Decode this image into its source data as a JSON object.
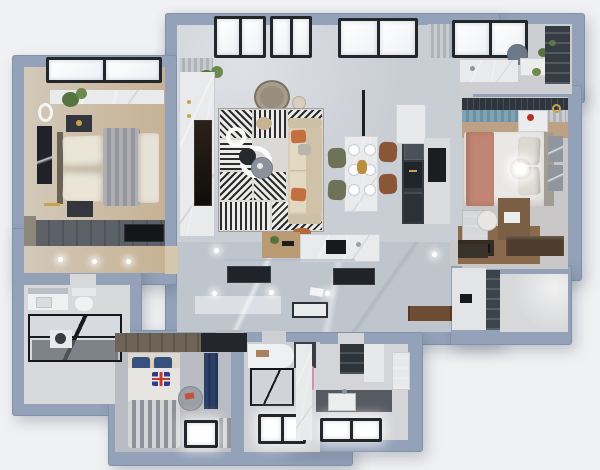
{
  "scene": {
    "type": "3d-floor-plan-top-view",
    "description": "Photorealistic top-down 3D render of a furnished apartment floor plan with blue-gray walls on a light background",
    "background_color": "#f0f1f3",
    "wall_color": "#93a2b9"
  },
  "palette": {
    "bg": "#f0f1f3",
    "wall": "#93a2b9",
    "wall-edge": "#8191aa",
    "glass-frame": "#23262b",
    "window-glass": "#fafbfd",
    "marble-floor": "#c9cdd4",
    "marble-dark": "#bfc5cd",
    "marble-white": "#e9eaec",
    "wood": "#c7b193",
    "wood-light": "#d6c6ab",
    "wood-dark": "#7a5f45",
    "dark-cabinet": "#343a42",
    "charcoal": "#202329",
    "white-soft": "#eceded",
    "sofa-beige": "#d9cdb6",
    "accent-orange": "#c4703e",
    "accent-salmon": "#c08573",
    "accent-navy": "#2c4066",
    "accent-teal": "#7fa3b5",
    "accent-pink": "#d98fa6",
    "accent-green": "#55743f",
    "chair-olive": "#6e7257",
    "chair-brown": "#8a5638",
    "accent-gold": "#c9a34a",
    "duvet-gray": "#9fa1a5",
    "floor-gray": "#b9bcc2",
    "bath-floor": "#d8d9db",
    "rug-base": "#dad9d5"
  },
  "rooms": [
    {
      "id": "living-room",
      "label": "Living Room",
      "furniture": [
        "interior-curtain",
        "potted-plant",
        "papasan-chair",
        "arc-floor-lamp",
        "marble-tv-wall",
        "wall-tv",
        "geometric-patch-rug",
        "nesting-ring-coffee-tables",
        "black-side-stool",
        "serving-tray",
        "round-cushion",
        "three-seat-sofa",
        "orange-accent-pillows",
        "orange-ottoman",
        "skylight-windows",
        "sheer-curtain",
        "wood-bar-counter",
        "island-counter-with-cooktop",
        "glass-screen"
      ]
    },
    {
      "id": "dining-area",
      "label": "Dining Area",
      "furniture": [
        "marble-dining-table",
        "six-place-settings",
        "gold-centerpiece",
        "linear-pendant-lamp",
        "olive-green-chairs",
        "terracotta-leather-chairs"
      ]
    },
    {
      "id": "kitchen",
      "label": "Kitchen",
      "furniture": [
        "tall-appliance-column",
        "built-in-ovens",
        "coffee-machine-niche",
        "white-wall-cabinet",
        "stone-counter",
        "black-appliance-deck"
      ]
    },
    {
      "id": "kitchen-balcony",
      "label": "Kitchen Balcony",
      "furniture": [
        "round-water-heater",
        "marble-counter",
        "sink-faucet",
        "white-appliance-box",
        "potted-plants",
        "tall-shelf-cabinet",
        "tilted-skylight"
      ]
    },
    {
      "id": "master-bedroom",
      "label": "Master Bedroom",
      "furniture": [
        "skylight-window",
        "marble-headboard-wall",
        "hanging-plant",
        "round-led-mirror",
        "black-wall-art",
        "double-bed",
        "cream-pillows",
        "gray-pleated-throw",
        "dark-nightstands",
        "gold-wall-lamp",
        "plank-wardrobe",
        "wall-tv",
        "side-dresser",
        "ceiling-spotlights"
      ]
    },
    {
      "id": "master-bathroom",
      "label": "Master Bathroom",
      "furniture": [
        "vanity-with-mirror",
        "toilet",
        "black-framed-glass-shower",
        "washer",
        "dark-wet-floor"
      ]
    },
    {
      "id": "hallway",
      "label": "Hallway",
      "furniture": [
        "black-wall-niches",
        "recessed-downlights",
        "glass-floor-threshold",
        "walnut-runner-rug",
        "entry-mat",
        "intercom-panel",
        "dark-storage-column"
      ]
    },
    {
      "id": "kids-bedroom",
      "label": "Kids Bedroom",
      "furniture": [
        "two-tone-wardrobe",
        "single-bed",
        "navy-pillows",
        "union-jack-pillow",
        "striped-duvet",
        "navy-curtain",
        "round-gray-side-table",
        "bright-bay-window",
        "striped-floor-mat"
      ]
    },
    {
      "id": "shower-bathroom",
      "label": "Shower Bathroom",
      "furniture": [
        "curved-vanity",
        "dark-mirror-cabinet",
        "wood-tray",
        "pink-towel",
        "black-framed-shower",
        "bright-bay-window"
      ]
    },
    {
      "id": "second-bathroom",
      "label": "Second Bathroom",
      "furniture": [
        "marble-feature-wall",
        "dark-storage-cabinet",
        "stone-vanity-counter",
        "white-sink",
        "laundry-column",
        "bright-bay-window"
      ]
    },
    {
      "id": "second-bedroom",
      "label": "Second Bedroom",
      "furniture": [
        "curtain-track",
        "slate-blue-curtain",
        "double-bed",
        "salmon-runner",
        "gray-pillows",
        "glowing-pendant",
        "white-nightstand",
        "red-decor",
        "gold-wall-ring-light",
        "framed-prints",
        "wood-desk",
        "white-chair",
        "display-bookcase",
        "tv-sideboard",
        "black-tv",
        "dark-sideboard"
      ]
    },
    {
      "id": "storage-room",
      "label": "Storage Room",
      "furniture": []
    }
  ]
}
